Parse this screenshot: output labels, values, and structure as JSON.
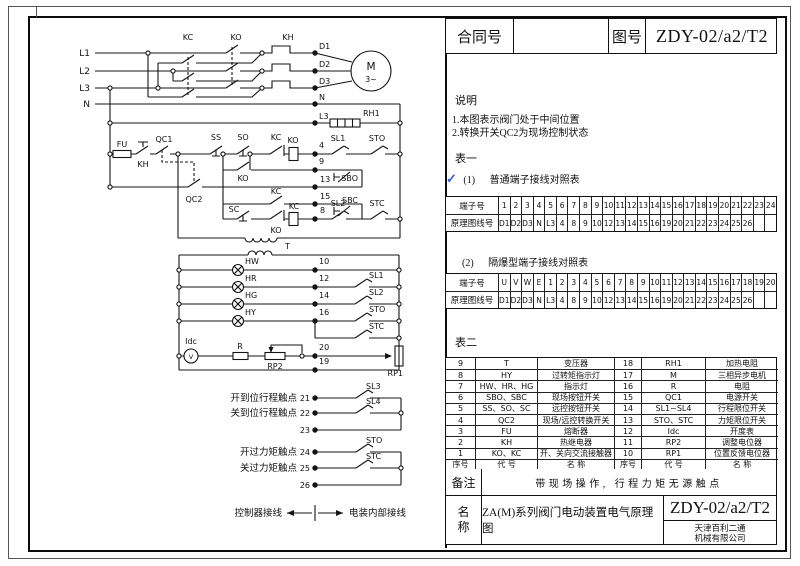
{
  "header": {
    "contract_label": "合同号",
    "contract_value": "",
    "drawing_label": "图号",
    "drawing_number": "ZDY-02/a2/T2"
  },
  "notes": {
    "title": "说明",
    "items": [
      "1.本图表示阀门处于中间位置",
      "2.转换开关QC2为现场控制状态"
    ]
  },
  "tables": {
    "table1_caption": "表一",
    "check_mark": "✓",
    "sub1_index": "(1)",
    "sub1_title": "普通端子接线对照表",
    "sub2_index": "(2)",
    "sub2_title": "隔爆型端子接线对照表",
    "table2_caption": "表二",
    "normal": {
      "terminal_label": "端子号",
      "wire_label": "原理图线号",
      "terminals": [
        "1",
        "2",
        "3",
        "4",
        "5",
        "6",
        "7",
        "8",
        "9",
        "10",
        "11",
        "12",
        "13",
        "14",
        "15",
        "16",
        "17",
        "18",
        "19",
        "20",
        "21",
        "22",
        "23",
        "24"
      ],
      "wires": [
        "D1",
        "D2",
        "D3",
        "N",
        "L3",
        "4",
        "8",
        "9",
        "10",
        "12",
        "13",
        "14",
        "15",
        "16",
        "19",
        "20",
        "21",
        "22",
        "23",
        "24",
        "25",
        "26",
        "",
        ""
      ]
    },
    "explosion_proof": {
      "terminal_label": "端子号",
      "wire_label": "原理图线号",
      "terminals": [
        "U",
        "V",
        "W",
        "E",
        "1",
        "2",
        "3",
        "4",
        "5",
        "6",
        "7",
        "8",
        "9",
        "10",
        "11",
        "12",
        "13",
        "14",
        "15",
        "16",
        "17",
        "18",
        "19",
        "20"
      ],
      "wires": [
        "D1",
        "D2",
        "D3",
        "N",
        "L3",
        "4",
        "8",
        "9",
        "10",
        "12",
        "13",
        "14",
        "15",
        "16",
        "19",
        "20",
        "21",
        "22",
        "23",
        "24",
        "25",
        "26",
        "",
        ""
      ]
    }
  },
  "component_table": {
    "rows": [
      [
        "9",
        "T",
        "变压器",
        "18",
        "RH1",
        "加热电阻"
      ],
      [
        "8",
        "HY",
        "过转矩指示灯",
        "17",
        "M",
        "三相异步电机"
      ],
      [
        "7",
        "HW、HR、HG",
        "指示灯",
        "16",
        "R",
        "电阻"
      ],
      [
        "6",
        "SBO、SBC",
        "现场按钮开关",
        "15",
        "QC1",
        "电源开关"
      ],
      [
        "5",
        "SS、SO、SC",
        "远控按钮开关",
        "14",
        "SL1~SL4",
        "行程限位开关"
      ],
      [
        "4",
        "QC2",
        "现场/远控转换开关",
        "13",
        "STO、STC",
        "力矩限位开关"
      ],
      [
        "3",
        "FU",
        "熔断器",
        "12",
        "Idc",
        "开度表"
      ],
      [
        "2",
        "KH",
        "热继电器",
        "11",
        "RP2",
        "调整电位器"
      ],
      [
        "1",
        "KO、KC",
        "开、关向交流接触器",
        "10",
        "RP1",
        "位置反馈电位器"
      ]
    ],
    "footer": [
      "序号",
      "代 号",
      "名 称",
      "序号",
      "代 号",
      "名 称"
    ]
  },
  "remark": {
    "label": "备注",
    "text": "带现场操作, 行程力矩无源触点"
  },
  "title_block": {
    "name_label_1": "名",
    "name_label_2": "称",
    "name_value": "ZA(M)系列阀门电动装置电气原理图",
    "drawing_number": "ZDY-02/a2/T2",
    "company_line1": "天津百利二通",
    "company_line2": "机械有限公司"
  },
  "colors": {
    "check_blue": "#3f5fc8",
    "line": "#141414"
  },
  "schematic": {
    "labels": {
      "l1": "L1",
      "l2": "L2",
      "l3": "L3",
      "n": "N",
      "kc_top": "KC",
      "ko_top": "KO",
      "kh_top": "KH",
      "d1": "D1",
      "d2": "D2",
      "d3": "D3",
      "n_term": "N",
      "l3_term": "L3",
      "rh1": "RH1",
      "motor": "M",
      "motor_phase": "3~",
      "fu": "FU",
      "kh_contact": "KH",
      "qc1": "QC1",
      "ss": "SS",
      "so": "SO",
      "kc_nc": "KC",
      "ko_coil": "KO",
      "t4": "4",
      "sl1_main": "SL1",
      "sto_main": "STO",
      "ko_aux": "KO",
      "t9": "9",
      "sbo": "SBO",
      "t13": "13",
      "qc2": "QC2",
      "kc_aux": "KC",
      "t15": "15",
      "sbc": "SBC",
      "sc": "SC",
      "ko_nc": "KO",
      "kc_coil": "KC",
      "t8": "8",
      "sl2_main": "SL2",
      "stc_main": "STC",
      "transformer": "T",
      "hw": "HW",
      "hr": "HR",
      "hg": "HG",
      "hy": "HY",
      "t10": "10",
      "t12": "12",
      "t14": "14",
      "t16": "16",
      "sl1_lamp": "SL1",
      "sl2_lamp": "SL2",
      "sto_lamp": "STO",
      "stc_lamp": "STC",
      "idc": "Idc",
      "r": "R",
      "rp2": "RP2",
      "t20": "20",
      "t19": "19",
      "rp1": "RP1",
      "meter_v": "V",
      "open_travel": "开到位行程触点",
      "t21": "21",
      "sl3": "SL3",
      "close_travel": "关到位行程触点",
      "t22": "22",
      "sl4": "SL4",
      "t23": "23",
      "open_torque": "开过力矩触点",
      "t24": "24",
      "sto_out": "STO",
      "close_torque": "关过力矩触点",
      "t25": "25",
      "stc_out": "STC",
      "t26": "26",
      "legend_left": "控制器接线",
      "legend_right": "电装内部接线"
    }
  }
}
